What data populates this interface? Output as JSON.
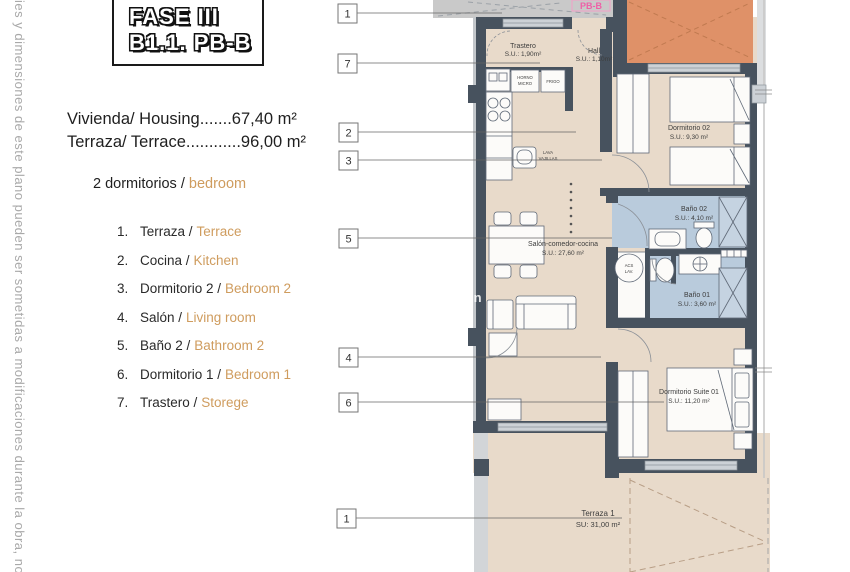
{
  "page": {
    "disclaimer": "ies y dimensiones de este plano pueden ser sometidas a modificaciones durante la obra, no tenie"
  },
  "panel": {
    "title_line1": "FASE III",
    "title_line2": "B1.1. PB-B",
    "housing_line1": "Vivienda/ Housing.......67,40 m²",
    "housing_line2": "Terraza/ Terrace............96,00 m²",
    "bedrooms_black": "2 dormitorios /",
    "bedrooms_orange": "bedroom",
    "legend": {
      "items": [
        {
          "num": "1.",
          "es": "Terraza /",
          "en": "Terrace"
        },
        {
          "num": "2.",
          "es": "Cocina /",
          "en": "Kitchen"
        },
        {
          "num": "3.",
          "es": "Dormitorio 2 /",
          "en": "Bedroom 2"
        },
        {
          "num": "4.",
          "es": "Salón /",
          "en": "Living room"
        },
        {
          "num": "5.",
          "es": "Baño 2 /",
          "en": "Bathroom 2"
        },
        {
          "num": "6.",
          "es": "Dormitorio 1 /",
          "en": "Bedroom 1"
        },
        {
          "num": "7.",
          "es": "Trastero /",
          "en": "Storege"
        }
      ]
    }
  },
  "plan": {
    "unit_tag": "PB-B",
    "watermark": "in",
    "callouts": [
      "1",
      "7",
      "2",
      "3",
      "5",
      "4",
      "6",
      "1"
    ],
    "rooms": {
      "trastero": {
        "name": "Trastero",
        "area": "S.U.: 1,90m²"
      },
      "hall": {
        "name": "Hall",
        "area": "S.U.: 1,10m²"
      },
      "dorm02": {
        "name": "Dormitorio 02",
        "area": "S.U.: 9,30 m²"
      },
      "bano02": {
        "name": "Baño 02",
        "area": "S.U.: 4,10 m²"
      },
      "bano01": {
        "name": "Baño 01",
        "area": "S.U.: 3,60 m²"
      },
      "suite": {
        "name": "Dormitorio Suite 01",
        "area": "S.U.: 11,20 m²"
      },
      "salon": {
        "name": "Salón-comedor-cocina",
        "area": "S.U.: 27,60 m²"
      },
      "terraza": {
        "name": "Terraza 1",
        "area": "SU: 31,00 m²"
      }
    },
    "appliances": {
      "horno_l1": "HORNO",
      "horno_l2": "MICRO",
      "frigo": "FRIGO",
      "lava_l1": "LAVA",
      "lava_l2": "VAJILLAS",
      "acs_l1": "ACS",
      "acs_l2": "LAV."
    },
    "colors": {
      "floor": "#e8daca",
      "wall": "#47525e",
      "bath_floor": "#b9cbdc",
      "terrace_orange": "#df9168",
      "accent_orange": "#cf9c5e",
      "unit_pink": "#ef5fa7",
      "common_gray": "#c9c9c9"
    }
  }
}
